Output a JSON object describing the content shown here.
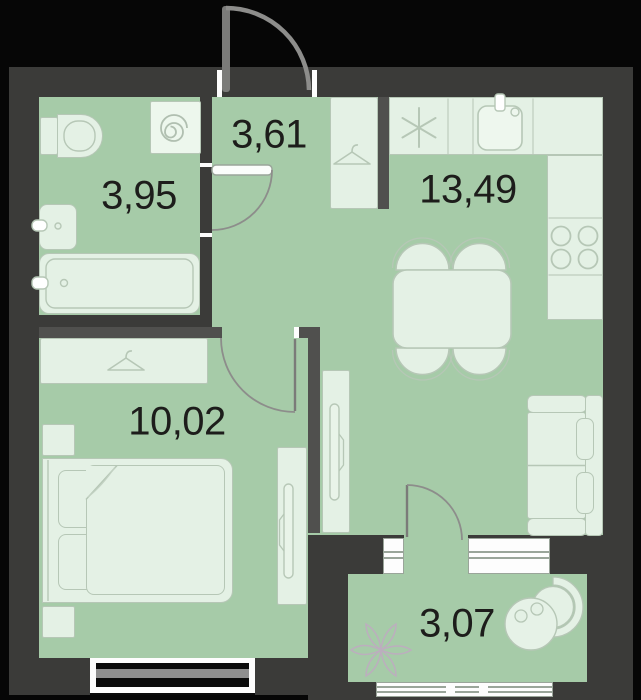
{
  "plan_title": "apartment-floor-plan",
  "rooms": [
    {
      "name": "bathroom",
      "area": "3,95"
    },
    {
      "name": "hallway",
      "area": "3,61"
    },
    {
      "name": "kitchen-living",
      "area": "13,49"
    },
    {
      "name": "bedroom",
      "area": "10,02"
    },
    {
      "name": "balcony",
      "area": "3,07"
    }
  ],
  "icons": {
    "washer_drum": "spiral-icon",
    "fridge_mark": "asterisk-icon",
    "closet_mark": "hanger-icon",
    "stove_mark": "four-burners-icon",
    "balcony_plant": "flower-icon"
  },
  "colors": {
    "background": "#060606",
    "wall": "#3b3b39",
    "partition": "#50504e",
    "floor": "#a6cba8",
    "furniture_fill": "#e4f1e5",
    "furniture_outline": "#b6c7b6",
    "door_arc": "#8d8d8b",
    "label_text": "#1d1d1b"
  }
}
